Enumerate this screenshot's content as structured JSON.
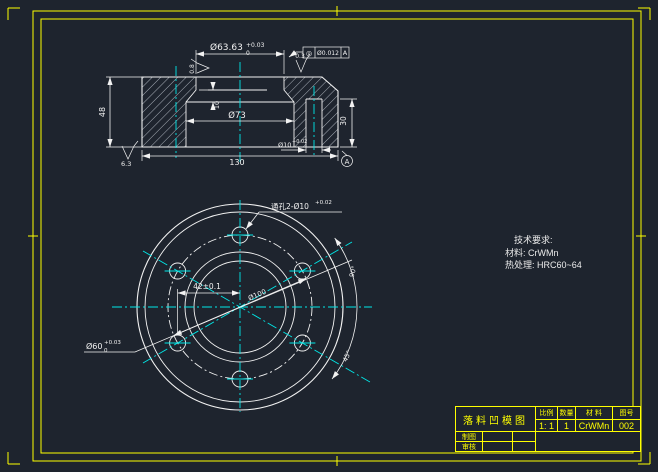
{
  "colors": {
    "background": "#1e242e",
    "line": "#f2f2f2",
    "centerline": "#00e8e8",
    "frame": "#ffff00"
  },
  "section_view": {
    "dim_bore": "Ø63.63",
    "dim_bore_tol_up": "+0.03",
    "dim_bore_tol_dn": "0",
    "roughness_top": "0.3",
    "roughness_wall": "0.8",
    "roughness_bottom": "6.3",
    "gdt_symbol": "◎",
    "gdt_tolerance": "Ø0.012",
    "gdt_datum": "A",
    "dim_inner": "Ø73",
    "dim_land": "10",
    "dim_height": "48",
    "dim_width": "130",
    "dim_step": "30",
    "dim_hole": "Ø10",
    "dim_hole_tol": "+0.02",
    "datum_label": "A"
  },
  "plan_view": {
    "leader_holes": "通孔2-Ø10",
    "leader_holes_tol": "+0.02",
    "dim_pitch": "42±0.1",
    "dim_bolt_circle": "Ø100",
    "dim_center_hole": "Ø60",
    "dim_center_hole_tol_up": "+0.03",
    "dim_center_hole_tol_dn": "0",
    "angle_upper": "90°",
    "angle_lower": "45°"
  },
  "tech_req": {
    "heading": "技术要求:",
    "material": "材料: CrWMn",
    "heat_treatment": "热处理: HRC60~64"
  },
  "title_block": {
    "title": "落料凹模图",
    "col_scale": "比例",
    "col_qty": "数量",
    "col_material": "材 料",
    "col_no": "图号",
    "scale": "1: 1",
    "qty": "1",
    "material": "CrWMn",
    "no": "002",
    "drafter": "制图",
    "checker": "审核"
  }
}
